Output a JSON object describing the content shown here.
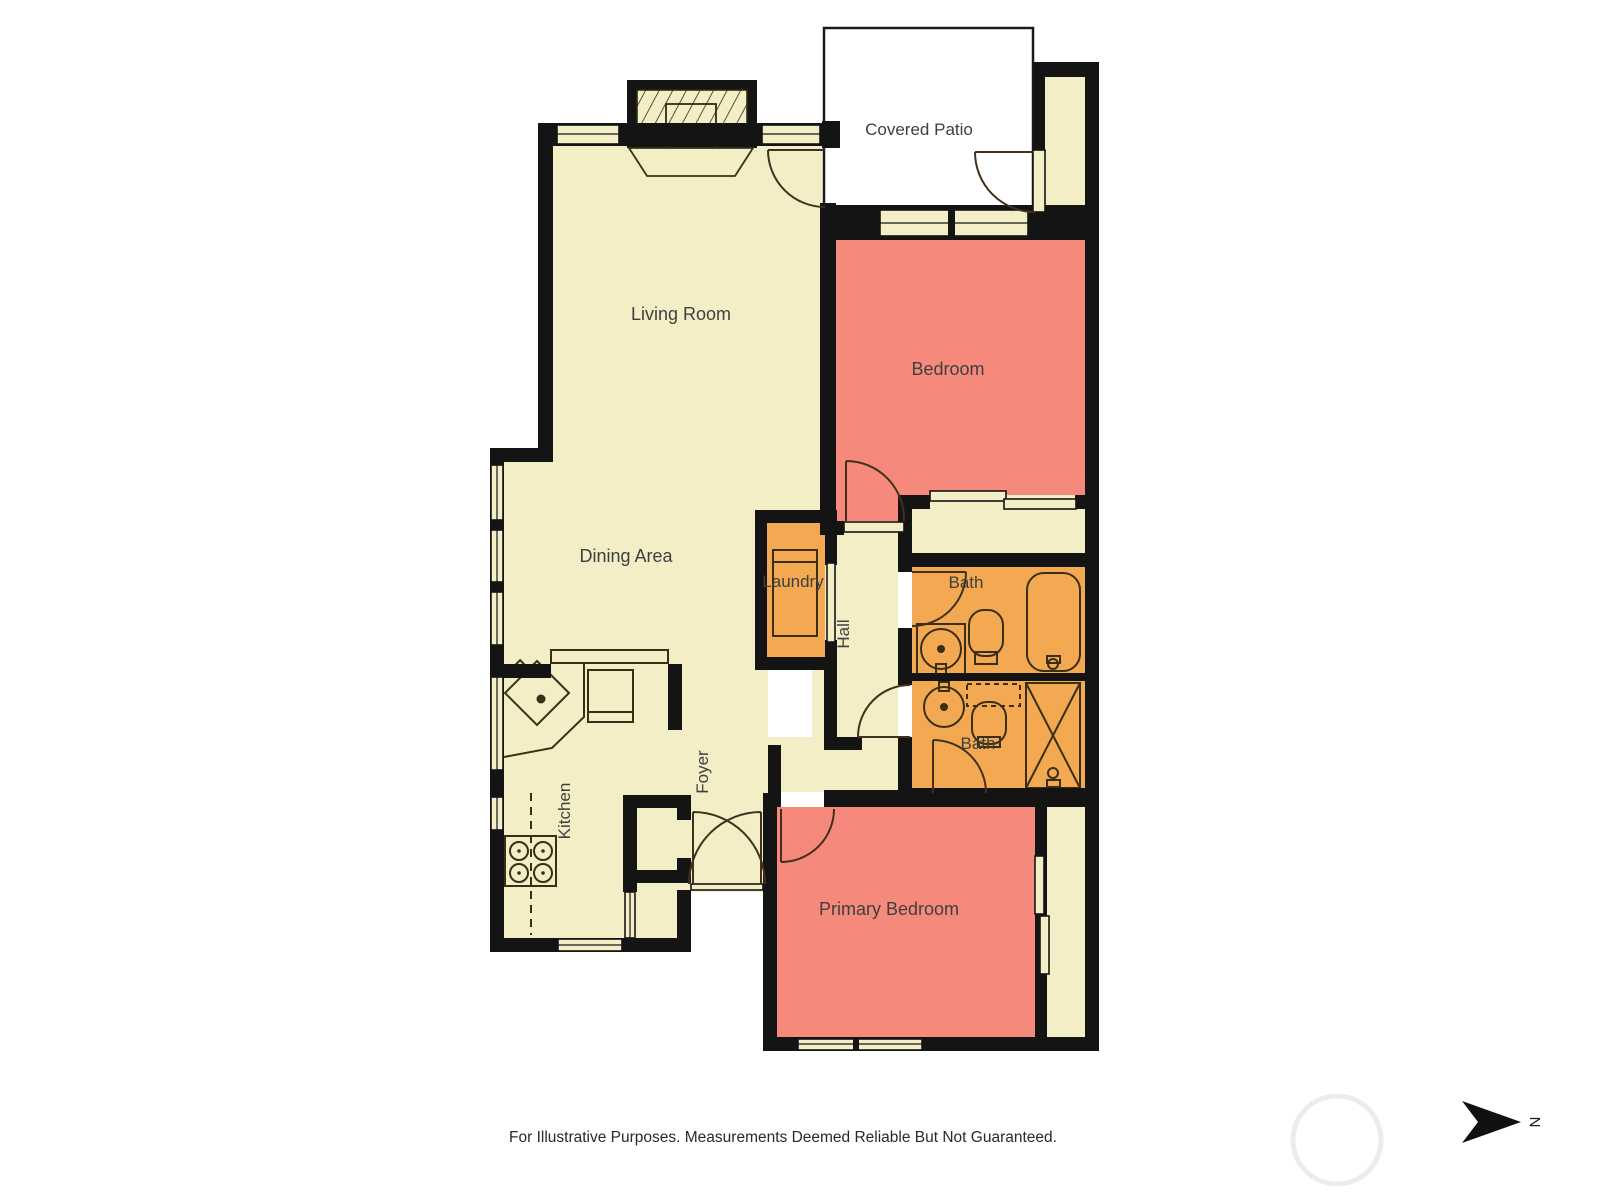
{
  "plan": {
    "disclaimer": "For Illustrative Purposes. Measurements Deemed Reliable But Not Guaranteed.",
    "north_label": "N",
    "rooms": [
      {
        "id": "living-room",
        "label": "Living Room"
      },
      {
        "id": "covered-patio",
        "label": "Covered Patio"
      },
      {
        "id": "bedroom",
        "label": "Bedroom"
      },
      {
        "id": "dining-area",
        "label": "Dining Area"
      },
      {
        "id": "laundry",
        "label": "Laundry"
      },
      {
        "id": "hall",
        "label": "Hall"
      },
      {
        "id": "bath-upper",
        "label": "Bath"
      },
      {
        "id": "bath-lower",
        "label": "Bath"
      },
      {
        "id": "kitchen",
        "label": "Kitchen"
      },
      {
        "id": "foyer",
        "label": "Foyer"
      },
      {
        "id": "primary-bedroom",
        "label": "Primary Bedroom"
      }
    ],
    "icons": [
      "fireplace-icon",
      "bathtub-icon",
      "shower-icon",
      "toilet-icon",
      "sink-icon",
      "washer-dryer-icon",
      "stove-icon",
      "kitchen-sink-icon",
      "refrigerator-icon",
      "north-arrow-icon"
    ]
  },
  "colors": {
    "floor_cream": "#F3EEC6",
    "bedroom_salmon": "#F58A7C",
    "wet_room_orange": "#F3A852",
    "wall_black": "#141414",
    "patio_white": "#FFFFFF",
    "label_text": "#3F3F3F",
    "fixture_line": "#3A2F16"
  }
}
